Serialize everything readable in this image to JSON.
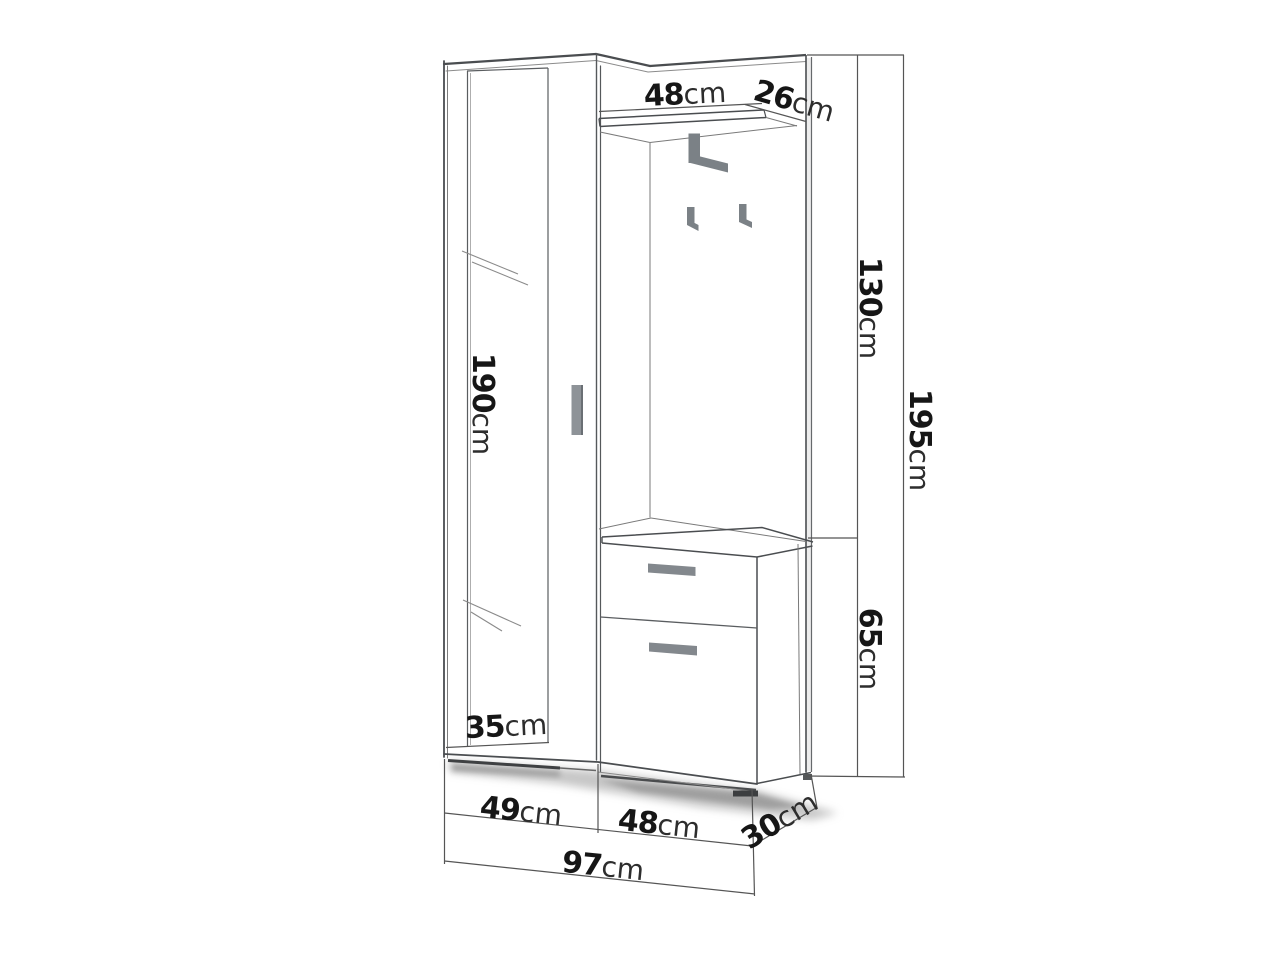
{
  "figure": {
    "type": "furniture dimension diagram",
    "subject": "hallway wardrobe set: mirrored wardrobe, coat rack panel with shelf and hooks, shoe cabinet with two drawers",
    "unit": "cm"
  },
  "dimensions": {
    "shelf_width": {
      "value": "48",
      "unit": "cm"
    },
    "shelf_depth": {
      "value": "26",
      "unit": "cm"
    },
    "upper_panel_height": {
      "value": "130",
      "unit": "cm"
    },
    "total_height": {
      "value": "195",
      "unit": "cm"
    },
    "mirror_door_height": {
      "value": "190",
      "unit": "cm"
    },
    "cabinet_height": {
      "value": "65",
      "unit": "cm"
    },
    "mirror_width": {
      "value": "35",
      "unit": "cm"
    },
    "wardrobe_width": {
      "value": "49",
      "unit": "cm"
    },
    "cabinet_width": {
      "value": "48",
      "unit": "cm"
    },
    "depth": {
      "value": "30",
      "unit": "cm"
    },
    "total_width": {
      "value": "97",
      "unit": "cm"
    }
  },
  "colors": {
    "background": "#ffffff",
    "outline": "#4a4d50",
    "thin_line": "#777777",
    "dimension_line": "#555555",
    "hardware_gray": "#7b8186",
    "handle_gray": "#83888d",
    "label_number": "#161616",
    "label_unit": "#2d2d2d"
  }
}
